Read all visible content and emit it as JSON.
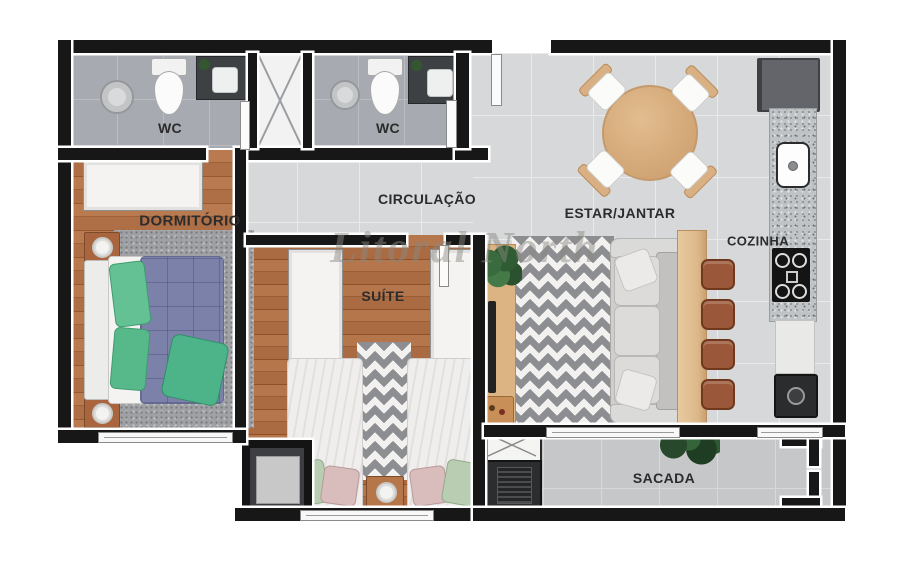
{
  "watermark": "Litoral North",
  "labels": {
    "wc_left": "WC",
    "wc_right": "WC",
    "dormitorio": "DORMITÓRIO",
    "circulacao": "CIRCULAÇÃO",
    "estar_jantar": "ESTAR/JANTAR",
    "suite": "SUÍTE",
    "cozinha": "COZINHA",
    "sacada": "SACADA"
  },
  "palette": {
    "wall": "#171717",
    "wood_floor": "#b0714a",
    "tile_living": "#d7d8da",
    "tile_wc": "#a7aab0",
    "tile_balcony": "#c6c7c9",
    "rug_speckle_gray": "#9fa1a5",
    "chevron_gray": "#8d8e92",
    "sofa_gray": "#cfcecc",
    "table_wood": "#d8b083",
    "stool_brown": "#9a5739",
    "duvet_blue": "#7b81a9",
    "pillow_green": "#63c193",
    "pillow_sage": "#b9cdb2",
    "pillow_pink": "#d9bcbc",
    "label_color": "#2c2c2c"
  }
}
